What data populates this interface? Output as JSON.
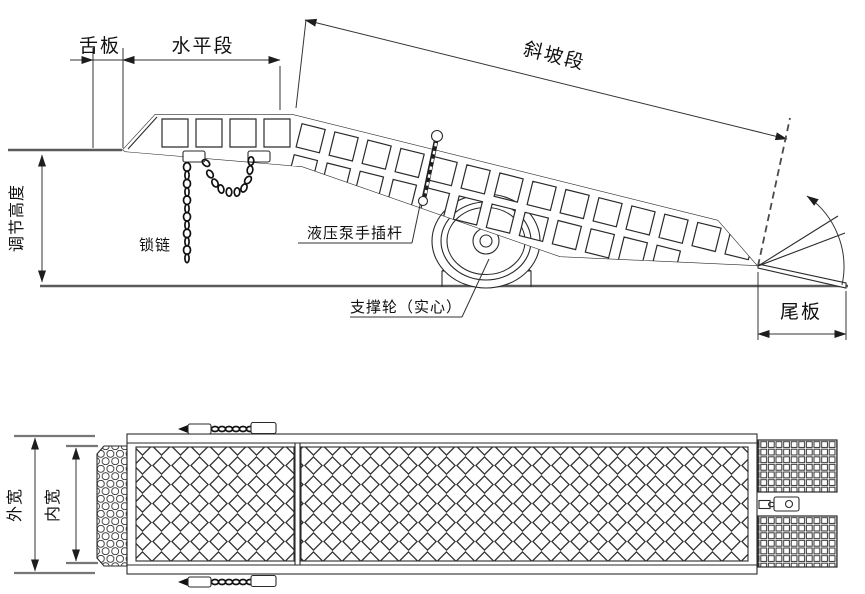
{
  "drawing": {
    "type": "technical-drawing",
    "line_color": "#2a2a2a",
    "background": "#ffffff"
  },
  "side_view": {
    "dim_tongue_plate": "舌板",
    "dim_horizontal_section": "水平段",
    "dim_slope_section": "斜坡段",
    "dim_adjust_height": "调节高度",
    "label_lock_chain": "锁链",
    "label_pump_rod": "液压泵手插杆",
    "label_support_wheel": "支撑轮（实心）",
    "dim_tail_plate": "尾板"
  },
  "plan_view": {
    "dim_outer_width": "外宽",
    "dim_inner_width": "内宽"
  }
}
